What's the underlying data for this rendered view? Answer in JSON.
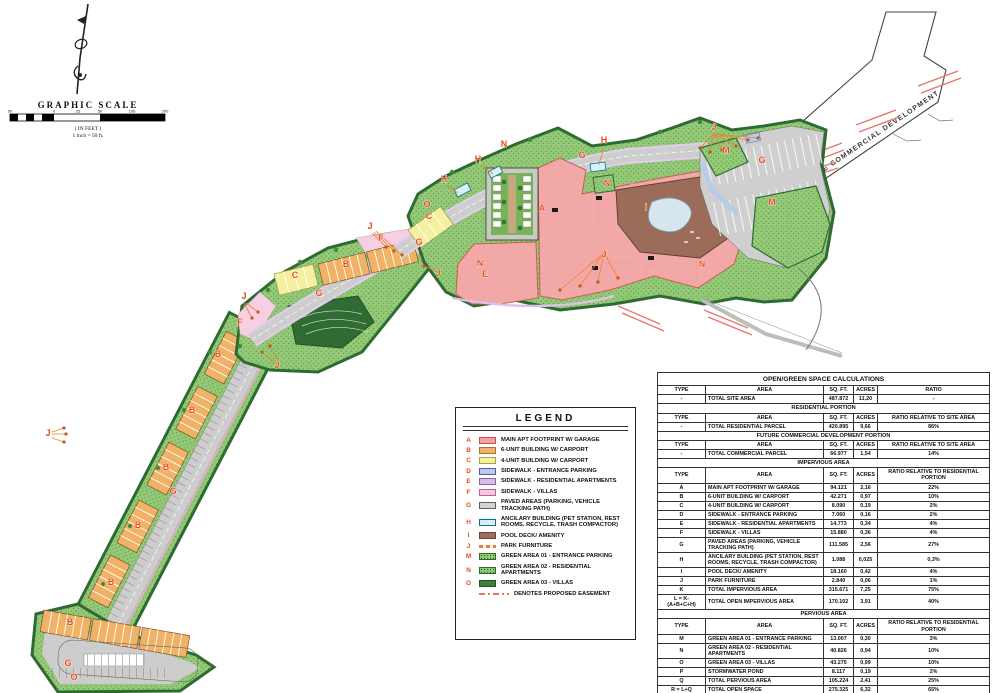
{
  "plan": {
    "future_label": "FUTURE COMMERCIAL DEVELOPMENT",
    "colors": {
      "label": "#e8491d",
      "easement": "#e8736a",
      "green_area": "#93c977",
      "dark_green_edge": "#2e6b33",
      "road_gray": "#cdcdcd"
    },
    "labels": [
      {
        "t": "A",
        "x": 542,
        "y": 211
      },
      {
        "t": "B",
        "x": 346,
        "y": 267
      },
      {
        "t": "B",
        "x": 218,
        "y": 357
      },
      {
        "t": "B",
        "x": 192,
        "y": 413
      },
      {
        "t": "B",
        "x": 166,
        "y": 470
      },
      {
        "t": "B",
        "x": 138,
        "y": 528
      },
      {
        "t": "B",
        "x": 111,
        "y": 585
      },
      {
        "t": "B",
        "x": 70,
        "y": 625
      },
      {
        "t": "C",
        "x": 429,
        "y": 219
      },
      {
        "t": "C",
        "x": 295,
        "y": 278
      },
      {
        "t": "E",
        "x": 485,
        "y": 277
      },
      {
        "t": "F",
        "x": 381,
        "y": 241
      },
      {
        "t": "F",
        "x": 240,
        "y": 325
      },
      {
        "t": "G",
        "x": 582,
        "y": 158
      },
      {
        "t": "G",
        "x": 762,
        "y": 163
      },
      {
        "t": "G",
        "x": 419,
        "y": 245
      },
      {
        "t": "G",
        "x": 319,
        "y": 296
      },
      {
        "t": "G",
        "x": 173,
        "y": 494
      },
      {
        "t": "G",
        "x": 68,
        "y": 666
      },
      {
        "t": "H",
        "x": 604,
        "y": 143
      },
      {
        "t": "H",
        "x": 478,
        "y": 162
      },
      {
        "t": "H",
        "x": 444,
        "y": 182
      },
      {
        "t": "I",
        "x": 646,
        "y": 210
      },
      {
        "t": "J",
        "x": 714,
        "y": 130
      },
      {
        "t": "J",
        "x": 604,
        "y": 257
      },
      {
        "t": "J",
        "x": 438,
        "y": 276
      },
      {
        "t": "J",
        "x": 370,
        "y": 229
      },
      {
        "t": "J",
        "x": 277,
        "y": 368
      },
      {
        "t": "J",
        "x": 244,
        "y": 299
      },
      {
        "t": "J",
        "x": 48,
        "y": 436
      },
      {
        "t": "M",
        "x": 726,
        "y": 153
      },
      {
        "t": "M",
        "x": 772,
        "y": 205
      },
      {
        "t": "N",
        "x": 504,
        "y": 147
      },
      {
        "t": "N",
        "x": 607,
        "y": 186
      },
      {
        "t": "N",
        "x": 480,
        "y": 266
      },
      {
        "t": "N",
        "x": 702,
        "y": 267
      },
      {
        "t": "O",
        "x": 427,
        "y": 207
      },
      {
        "t": "O",
        "x": 74,
        "y": 680
      }
    ]
  },
  "scale": {
    "title": "GRAPHIC SCALE",
    "unit_note": "( IN FEET )",
    "ratio_note": "1 inch = 50 ft.",
    "ticks": [
      {
        "v": "50",
        "x": 0
      },
      {
        "v": "0",
        "x": 44
      },
      {
        "v": "25",
        "x": 68
      },
      {
        "v": "50",
        "x": 90
      },
      {
        "v": "100",
        "x": 122
      },
      {
        "v": "200",
        "x": 155
      }
    ]
  },
  "legend": {
    "title": "LEGEND",
    "items": [
      {
        "key": "A",
        "label": "MAIN APT FOOTPRINT W/ GARAGE",
        "swatch": {
          "type": "rect",
          "fill": "#f2a2a2",
          "stroke": "#c0504d"
        }
      },
      {
        "key": "B",
        "label": "6-UNIT BUILDING W/ CARPORT",
        "swatch": {
          "type": "rect",
          "fill": "#f0b266",
          "stroke": "#b07030"
        }
      },
      {
        "key": "C",
        "label": "4-UNIT BUILDING W/ CARPORT",
        "swatch": {
          "type": "rect",
          "fill": "#f5f0a0",
          "stroke": "#b0a040"
        }
      },
      {
        "key": "D",
        "label": "SIDEWALK - ENTRANCE PARKING",
        "swatch": {
          "type": "rect",
          "fill": "#b9cbe8",
          "stroke": "#5060a0"
        }
      },
      {
        "key": "E",
        "label": "SIDEWALK - RESIDENTIAL APARTMENTS",
        "swatch": {
          "type": "rect",
          "fill": "#d9bce8",
          "stroke": "#9060b0"
        }
      },
      {
        "key": "F",
        "label": "SIDEWALK - VILLAS",
        "swatch": {
          "type": "rect",
          "fill": "#f6c6dd",
          "stroke": "#c060a0"
        }
      },
      {
        "key": "G",
        "label": "PAVED AREAS (PARKING, VEHICLE TRACKING PATH)",
        "swatch": {
          "type": "rect",
          "fill": "#d4d4d4",
          "stroke": "#606060"
        }
      },
      {
        "key": "H",
        "label": "ANCILARY BUILDING (PET STATION, REST ROOMS, RECYCLE, TRASH COMPACTOR)",
        "swatch": {
          "type": "rect",
          "fill": "#d8f0f4",
          "stroke": "#107090"
        }
      },
      {
        "key": "I",
        "label": "POOL DECK/ AMENITY",
        "swatch": {
          "type": "rect",
          "fill": "#a06e5c",
          "stroke": "#6b4438"
        }
      },
      {
        "key": "J",
        "label": "PARK FURNITURE",
        "swatch": {
          "type": "dash",
          "fill": "#f08030",
          "stroke": "#f08030"
        }
      },
      {
        "key": "M",
        "label": "GREEN AREA 01 - ENTRANCE PARKING",
        "swatch": {
          "type": "dots",
          "fill": "#8fc86e",
          "stroke": "#2e6b33"
        }
      },
      {
        "key": "N",
        "label": "GREEN AREA 02 - RESIDENTIAL APARTMENTS",
        "swatch": {
          "type": "dots",
          "fill": "#8fc86e",
          "stroke": "#2e6b33"
        }
      },
      {
        "key": "O",
        "label": "GREEN AREA 03 - VILLAS",
        "swatch": {
          "type": "rect",
          "fill": "#3f7f37",
          "stroke": "#245522"
        }
      },
      {
        "key": "",
        "label": "DENOTES PROPOSED EASEMENT",
        "swatch": {
          "type": "dashdot",
          "fill": "#e8736a",
          "stroke": "#e8736a"
        }
      }
    ]
  },
  "table": {
    "title": "OPEN/GREEN SPACE CALCULATIONS",
    "sections": [
      {
        "header": null,
        "cols": [
          "TYPE",
          "AREA",
          "SQ. FT.",
          "ACRES",
          "RATIO"
        ],
        "rows": [
          [
            "-",
            "TOTAL SITE AREA",
            "487.872",
            "11,20",
            "-"
          ]
        ]
      },
      {
        "header": "RESIDENTIAL PORTION",
        "cols": [
          "TYPE",
          "AREA",
          "SQ. FT.",
          "ACRES",
          "RATIO RELATIVE TO SITE AREA"
        ],
        "rows": [
          [
            "-",
            "TOTAL RESIDENTIAL PARCEL",
            "420.895",
            "9,66",
            "86%"
          ]
        ]
      },
      {
        "header": "FUTURE COMMERCIAL DEVELOPMENT PORTION",
        "cols": [
          "TYPE",
          "AREA",
          "SQ. FT.",
          "ACRES",
          "RATIO RELATIVE TO SITE AREA"
        ],
        "rows": [
          [
            "-",
            "TOTAL COMMERCIAL PARCEL",
            "66.977",
            "1,54",
            "14%"
          ]
        ]
      },
      {
        "header": "IMPERVIOUS AREA",
        "cols": [
          "TYPE",
          "AREA",
          "SQ. FT.",
          "ACRES",
          "RATIO RELATIVE TO RESIDENTIAL PORTION"
        ],
        "rows": [
          [
            "A",
            "MAIN APT FOOTPRINT W/ GARAGE",
            "94.121",
            "2,16",
            "22%"
          ],
          [
            "B",
            "6-UNIT BUILDING W/ CARPORT",
            "42.271",
            "0,97",
            "10%"
          ],
          [
            "C",
            "4-UNIT BUILDING W/ CARPORT",
            "8.090",
            "0,19",
            "2%"
          ],
          [
            "D",
            "SIDEWALK - ENTRANCE PARKING",
            "7.060",
            "0,16",
            "2%"
          ],
          [
            "E",
            "SIDEWALK - RESIDENTIAL APARTMENTS",
            "14.773",
            "0,34",
            "4%"
          ],
          [
            "F",
            "SIDEWALK - VILLAS",
            "15.880",
            "0,36",
            "4%"
          ],
          [
            "G",
            "PAVED AREAS (PARKING, VEHICLE TRACKING PATH)",
            "111.585",
            "2,56",
            "27%"
          ],
          [
            "H",
            "ANCILARY BUILDING (PET STATION, REST ROOMS, RECYCLE, TRASH COMPACTOR)",
            "1.088",
            "0,025",
            "0,3%"
          ],
          [
            "I",
            "POOL DECK/ AMENITY",
            "18.160",
            "0,42",
            "4%"
          ],
          [
            "J",
            "PARK FURNITURE",
            "2.840",
            "0,06",
            "1%"
          ],
          [
            "K",
            "TOTAL IMPERVIOUS AREA",
            "315.671",
            "7,25",
            "75%"
          ],
          [
            "L = K-(A+B+C+H)",
            "TOTAL OPEN IMPERVIOUS AREA",
            "170.102",
            "3,91",
            "40%"
          ]
        ]
      },
      {
        "header": "PERVIOUS AREA",
        "cols": [
          "TYPE",
          "AREA",
          "SQ. FT.",
          "ACRES",
          "RATIO RELATIVE TO RESIDENTIAL PORTION"
        ],
        "rows": [
          [
            "M",
            "GREEN AREA 01 - ENTRANCE PARKING",
            "13.007",
            "0,30",
            "3%"
          ],
          [
            "N",
            "GREEN AREA 02 - RESIDENTIAL APARTMENTS",
            "40.826",
            "0,94",
            "10%"
          ],
          [
            "O",
            "GREEN AREA 03 - VILLAS",
            "43.275",
            "0,99",
            "10%"
          ],
          [
            "P",
            "STORMWATER POND",
            "8.117",
            "0,19",
            "2%"
          ],
          [
            "Q",
            "TOTAL PERVIOUS AREA",
            "105.224",
            "2,41",
            "25%"
          ],
          [
            "R = L+Q",
            "TOTAL OPEN SPACE",
            "275.325",
            "6,32",
            "65%"
          ]
        ]
      }
    ]
  }
}
